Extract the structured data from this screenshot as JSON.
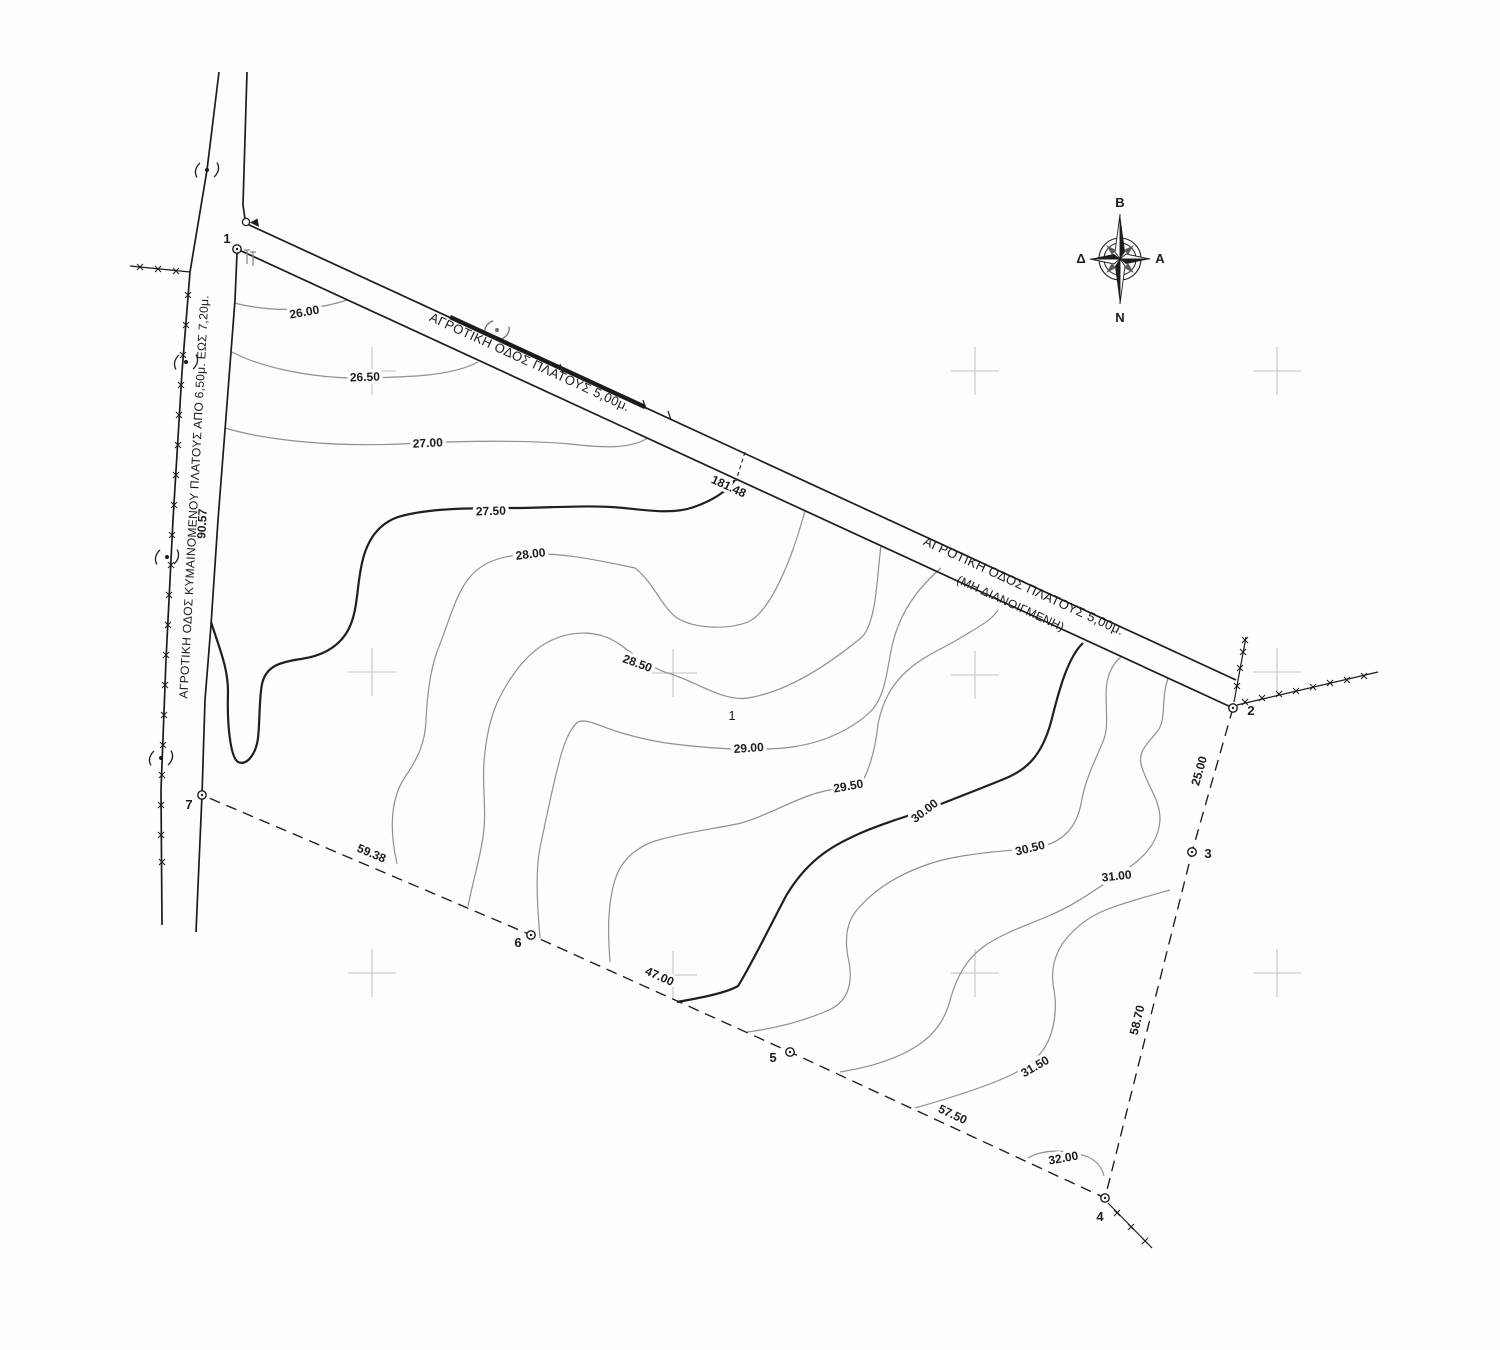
{
  "title": "Topographic survey plan",
  "compass": {
    "north": "B",
    "south": "N",
    "east": "A",
    "west": "Δ"
  },
  "roads": {
    "west_label": "ΑΓΡΟΤΙΚΗ ΟΔΟΣ ΚΥΜΑΙΝΟΜΕΝΟΥ ΠΛΑΤΟΥΣ ΑΠΟ 6,50μ. ΕΩΣ 7,20μ.",
    "north_label": "ΑΓΡΟΤΙΚΗ ΟΔΟΣ ΠΛΑΤΟΥΣ 5,00μ.",
    "east_label_line1": "ΑΓΡΟΤΙΚΗ ΟΔΟΣ ΠΛΑΤΟΥΣ 5,00μ.",
    "east_label_line2": "(ΜΗ ΔΙΑΝΟΙΓΜΕΝΗ)"
  },
  "parcel": {
    "number": "1"
  },
  "points": {
    "labels": [
      "1",
      "2",
      "3",
      "4",
      "5",
      "6",
      "7"
    ]
  },
  "dims": {
    "p1_p2": "181.48",
    "p2_p3": "25.00",
    "p3_p4": "58.70",
    "p4_p5": "57.50",
    "p5_p6": "47.00",
    "p6_p7": "59.38",
    "p7_p1": "90.57"
  },
  "contours": {
    "labels": [
      "26.00",
      "26.50",
      "27.00",
      "27.50",
      "28.00",
      "28.50",
      "29.00",
      "29.50",
      "30.00",
      "30.50",
      "31.00",
      "31.50",
      "32.00"
    ]
  },
  "colors": {
    "line": "#1c1c1c",
    "contour": "#8f8f8f",
    "contour_index": "#1f1f1f",
    "grid_cross": "#c4c4c4",
    "paper": "#fdfdfc"
  }
}
